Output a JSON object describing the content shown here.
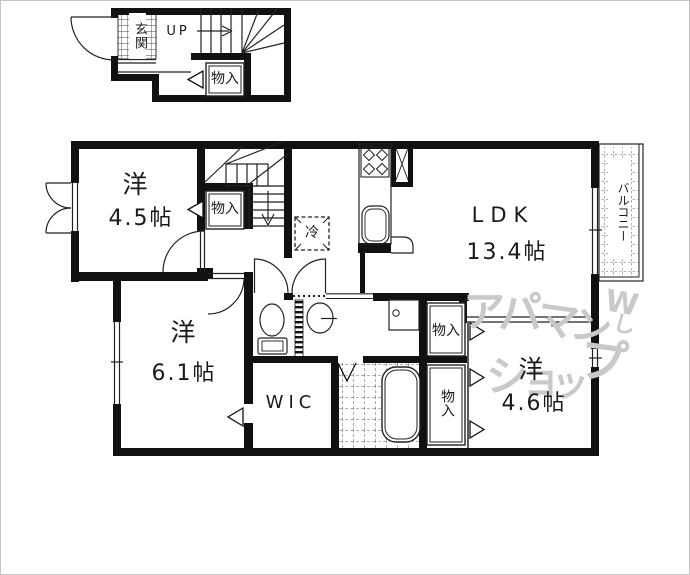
{
  "floor1": {
    "entrance_label": "玄関",
    "stairs_label": "UP",
    "closet_label": "物入"
  },
  "floor2": {
    "bedroom1_name": "洋",
    "bedroom1_size": "4.5帖",
    "stair_closet_label": "物入",
    "fridge_label": "冷",
    "ldk_name": "LDK",
    "ldk_size": "13.4帖",
    "balcony_label": "バルコニー",
    "bedroom2_name": "洋",
    "bedroom2_size": "6.1帖",
    "wic_label": "WIC",
    "closet_upper_label": "物入",
    "closet_lower_label": "物入",
    "bedroom3_name": "洋",
    "bedroom3_size": "4.6帖"
  },
  "watermark": {
    "chars": [
      "ア",
      "パ",
      "マ",
      "ン",
      "シ",
      "ョ",
      "ッ",
      "プ"
    ],
    "logo_top": "W",
    "logo_bottom": "し"
  },
  "colors": {
    "wall": "#111111",
    "watermark": "#c9c9c9",
    "background": "#ffffff"
  }
}
